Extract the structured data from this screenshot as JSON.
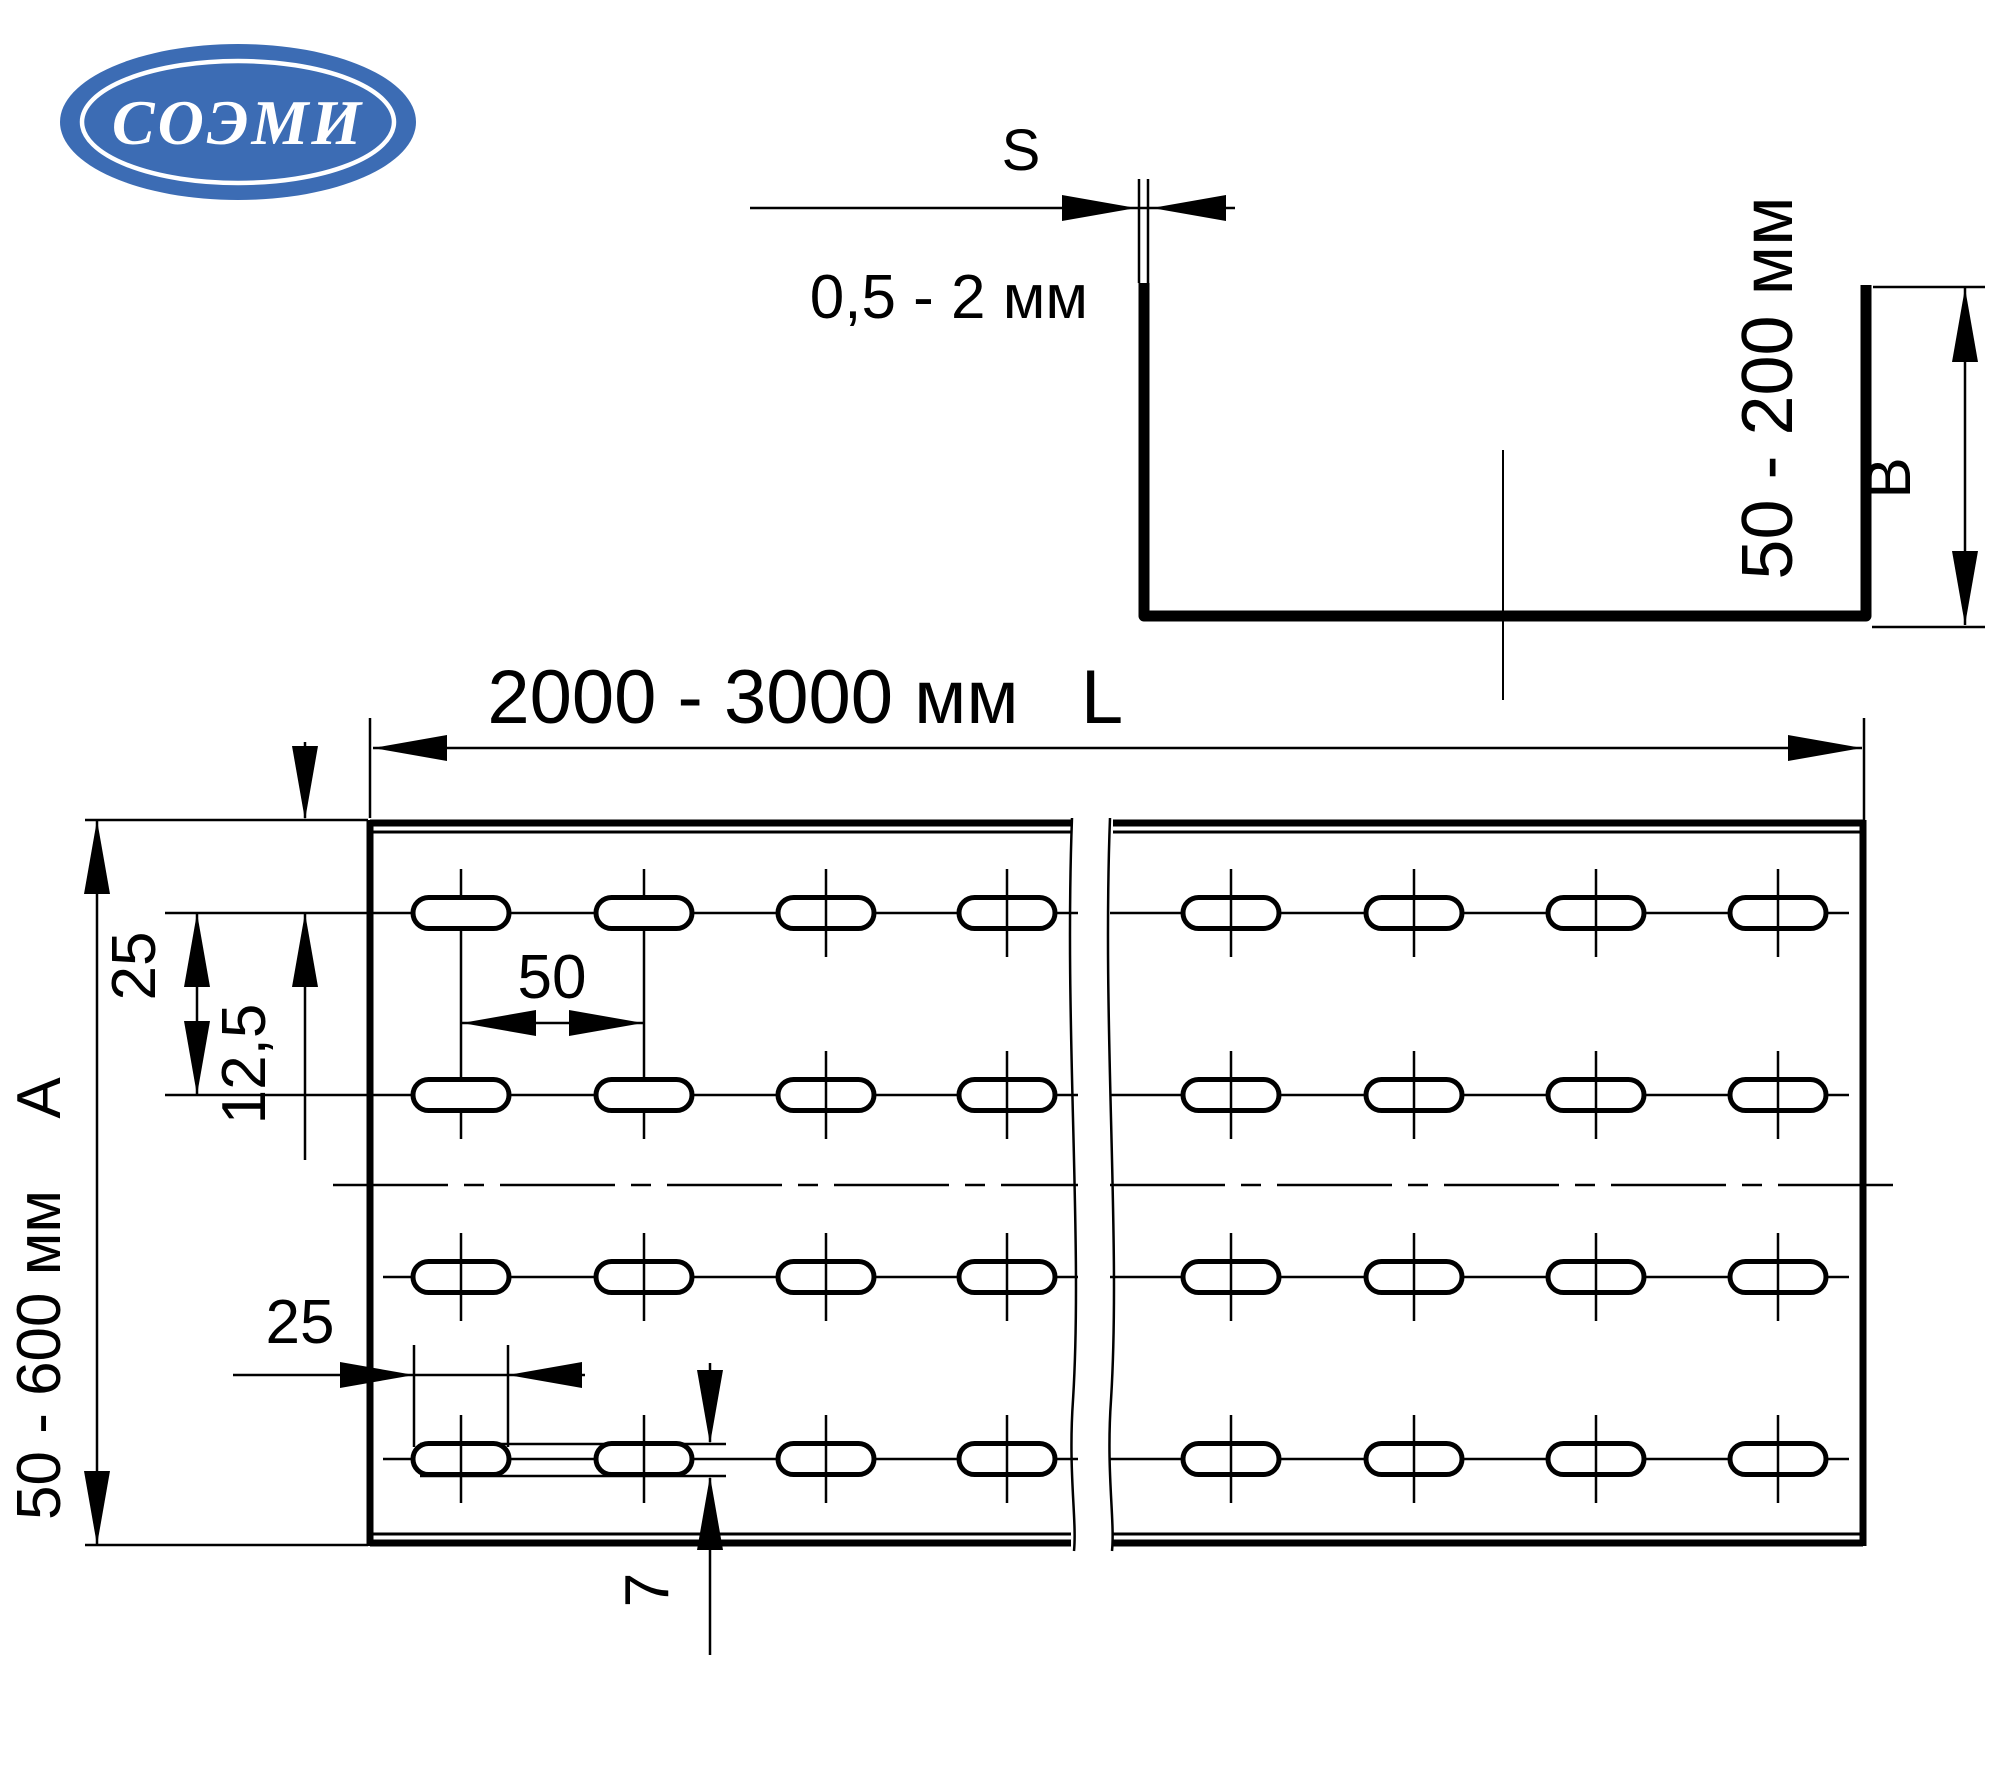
{
  "logo": {
    "text": "СОЭМИ"
  },
  "colors": {
    "logo_blue": "#3c6cb4",
    "logo_text": "#ffffff",
    "ink": "#000000"
  },
  "cross_section": {
    "thickness_letter": "S",
    "thickness_range": "0,5 - 2 мм",
    "height_range": "50 - 200 мм",
    "height_letter": "В"
  },
  "plan_view": {
    "length_range": "2000 - 3000 мм",
    "length_letter": "L",
    "width_range": "50 - 600 мм",
    "width_letter": "А",
    "row_pitch": "25",
    "edge_offset": "12,5",
    "slot_pitch": "50",
    "slot_length": "25",
    "slot_width": "7"
  }
}
